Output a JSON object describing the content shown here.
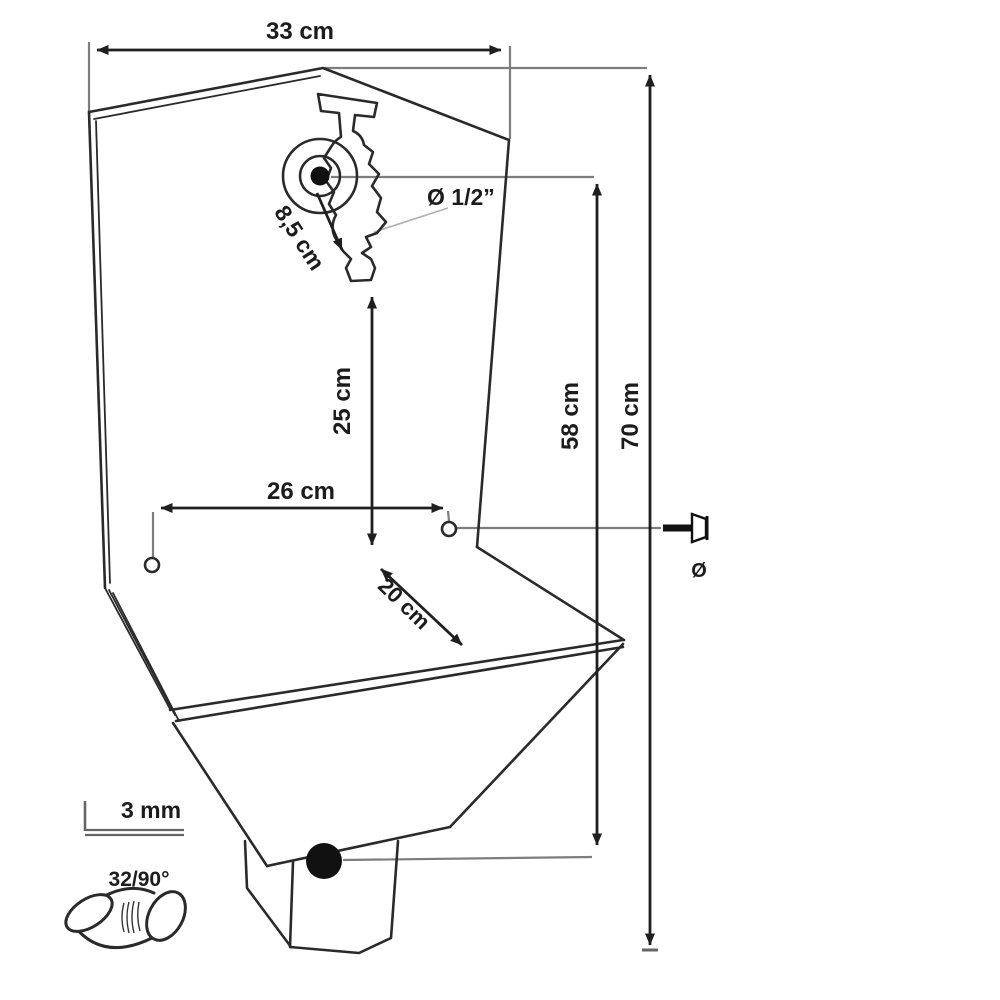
{
  "drawing": {
    "type": "technical-dimension-drawing",
    "subject": "wall-mounted sheet-metal sink with tap, front view with mounting dimensions",
    "colors": {
      "background": "#ffffff",
      "outline": "#2a2a2a",
      "dimension_line": "#1f1f1f",
      "reference_line": "#7d7d7d",
      "fill_dot": "#111111"
    },
    "labels": {
      "width_top": "33 cm",
      "tap_offset": "8,5 cm",
      "tap_thread": "Ø 1/2”",
      "spout_height": "25 cm",
      "hole_height": "58 cm",
      "total_height": "70 cm",
      "hole_spacing": "26 cm",
      "basin_depth": "20 cm",
      "sheet_thickness": "3 mm",
      "elbow_spec": "32/90°",
      "screw_diameter": "Ø"
    },
    "icons": [
      {
        "name": "tap-icon",
        "meaning": "wall bib tap with round flange"
      },
      {
        "name": "mounting-hole",
        "meaning": "wall fixing hole (2x)"
      },
      {
        "name": "screw-icon",
        "meaning": "countersunk fixing screw"
      },
      {
        "name": "drain-dot",
        "meaning": "drain outlet"
      },
      {
        "name": "l-profile-icon",
        "meaning": "3 mm sheet/edge profile"
      },
      {
        "name": "elbow-icon",
        "meaning": "32 mm / 90° waste elbow"
      }
    ]
  }
}
